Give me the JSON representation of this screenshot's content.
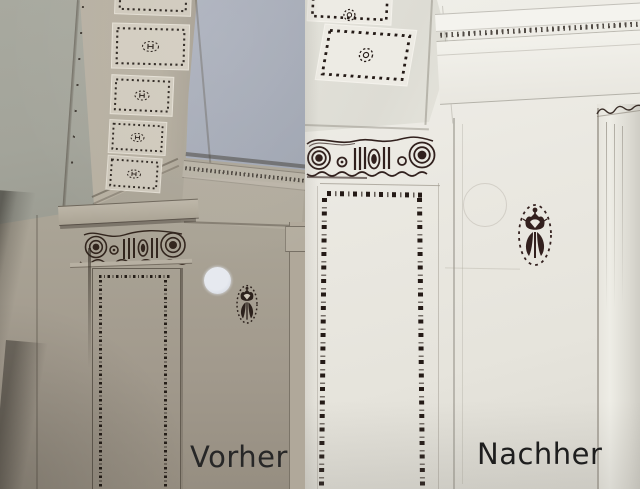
{
  "comparison": {
    "subject": "Restoration of stencilled ceiling, capital and pilaster ornament",
    "before": {
      "label": "Vorher"
    },
    "after": {
      "label": "Nachher"
    }
  },
  "colors": {
    "left_wall_green": "#a3a59a",
    "left_ceiling_blue": "#a9aeba",
    "left_beam_beige": "#b6afa2",
    "left_coffer_panel": "#d2ccbf",
    "ornament_dark_left": "#30241d",
    "right_background": "#eae8e1",
    "right_highlight": "#f4f3ee",
    "ornament_maroon_right": "#33201e",
    "test_patch": "#dfe3ea",
    "label_text": "#222222"
  },
  "ornament_names": [
    "coffer-medallion",
    "ionic-scroll-frieze",
    "thistle-stencil",
    "dentil-cornice",
    "dotted-band-border"
  ]
}
